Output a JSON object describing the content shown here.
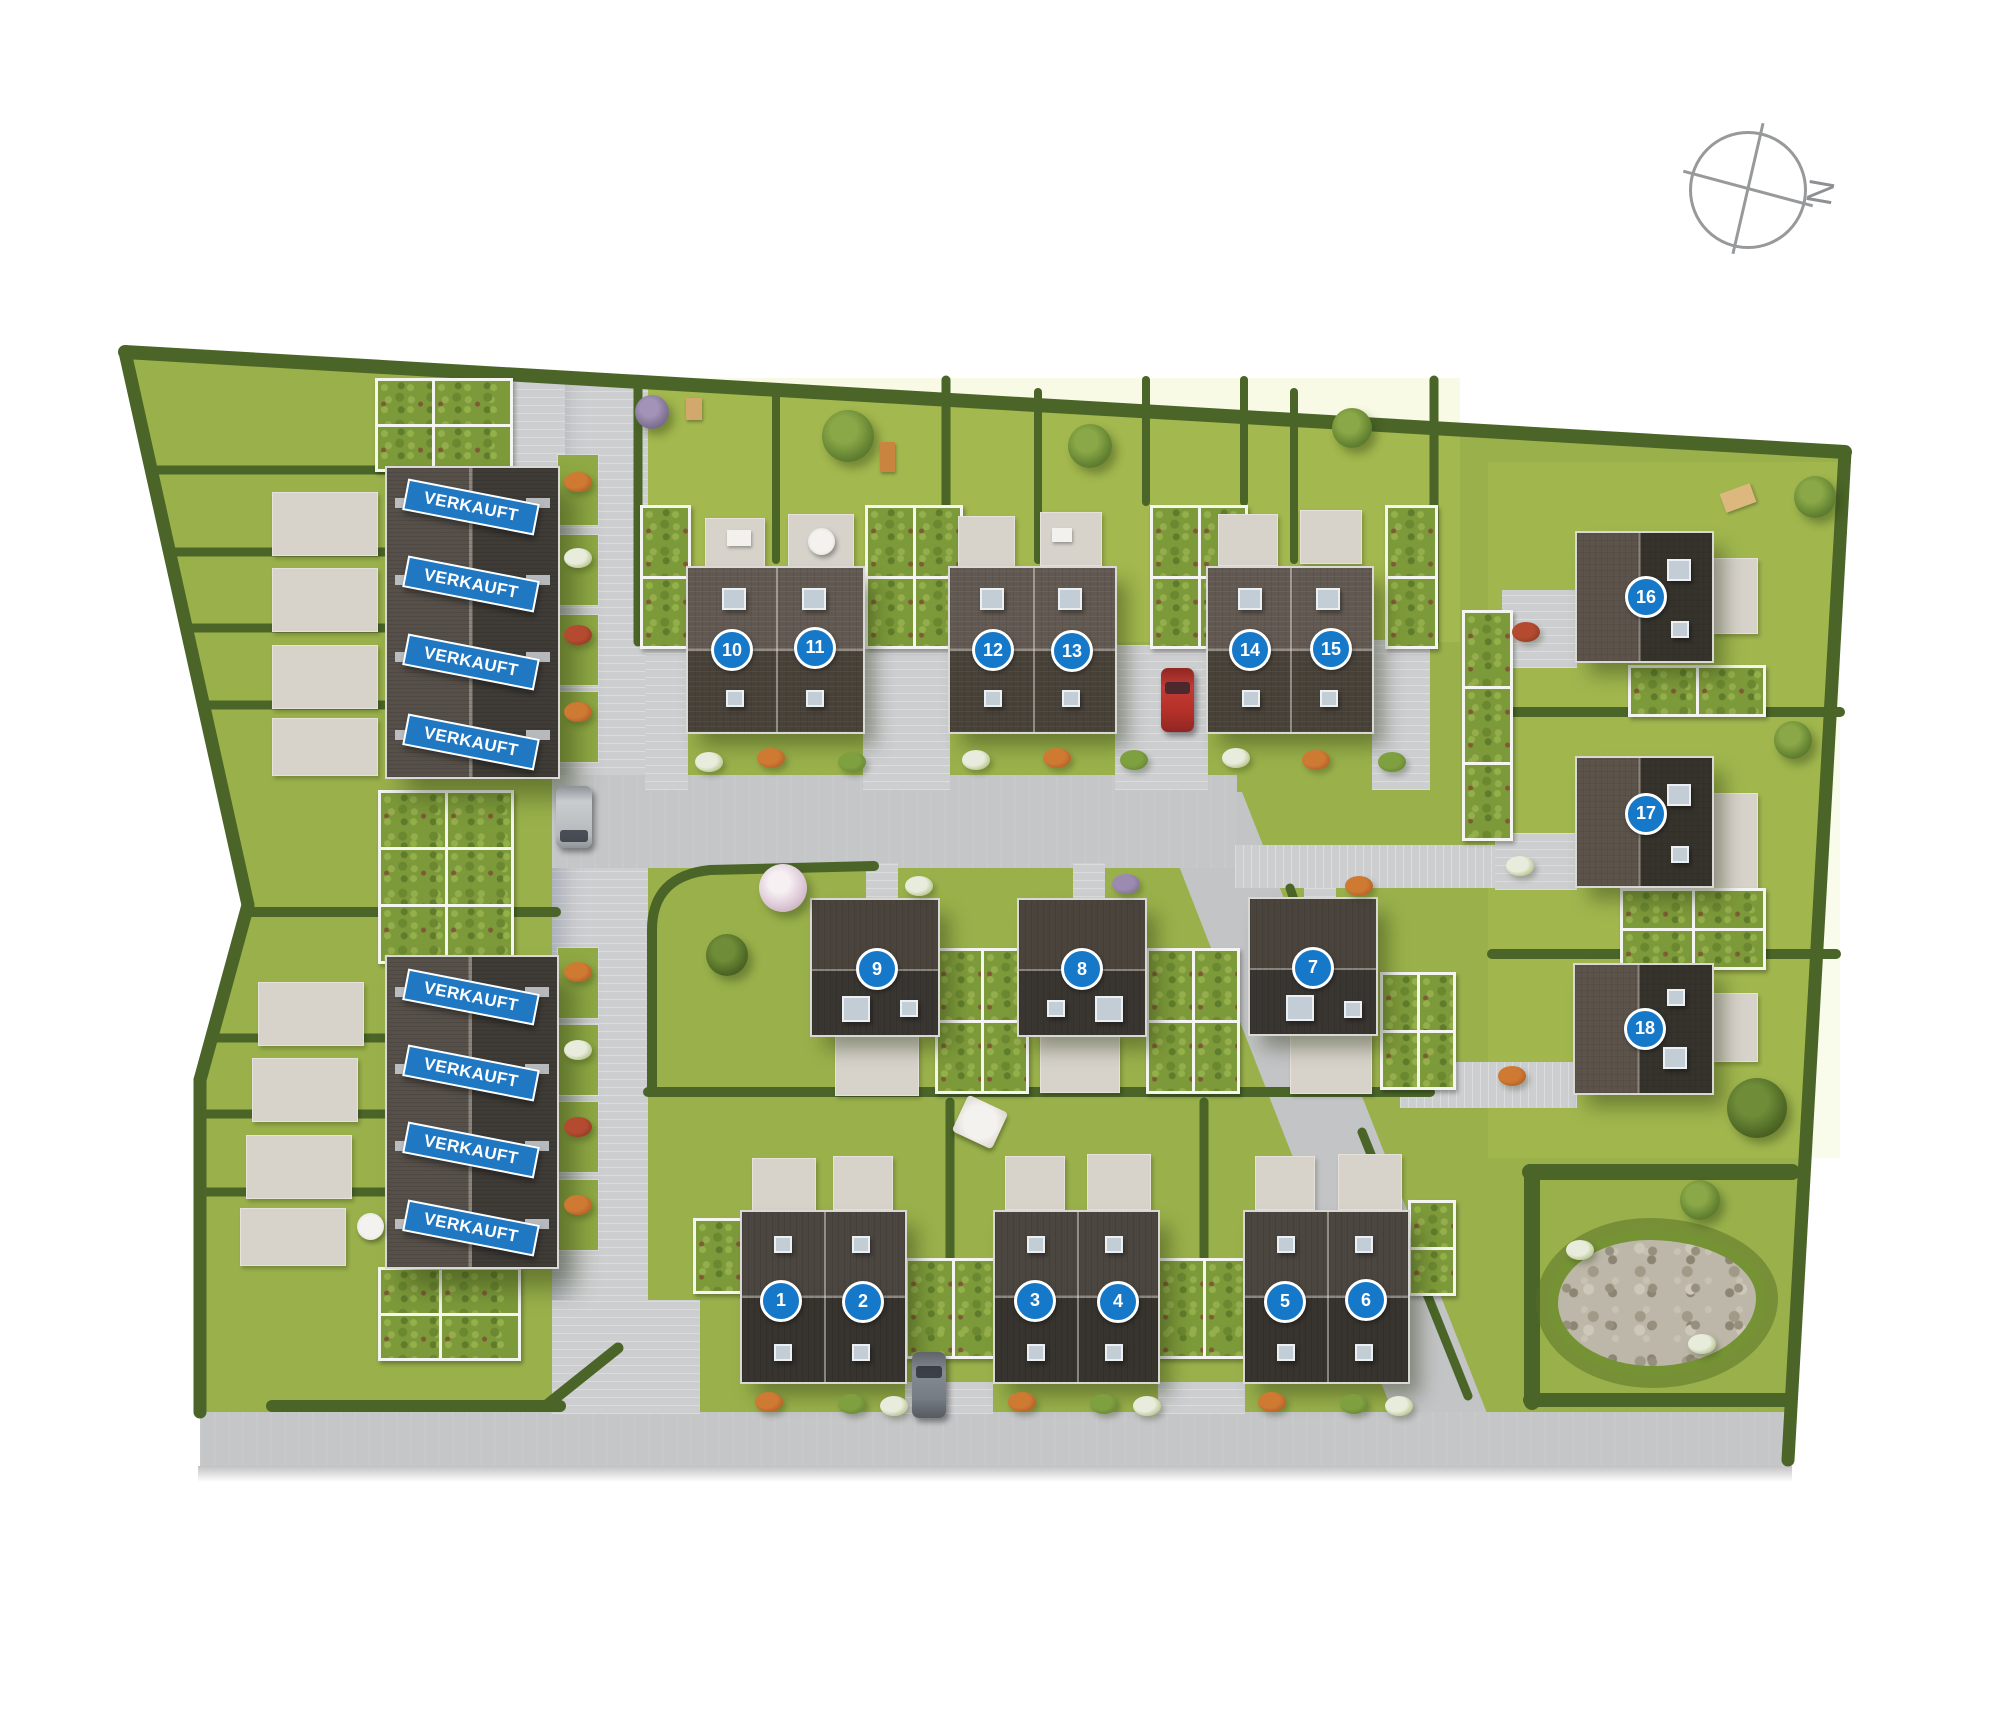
{
  "compass": {
    "label": "N"
  },
  "sold_label": "VERKAUFT",
  "banners": [
    {
      "label": "VERKAUFT",
      "x_pct": 23.55,
      "y_pct": 29.36
    },
    {
      "label": "VERKAUFT",
      "x_pct": 23.55,
      "y_pct": 33.82
    },
    {
      "label": "VERKAUFT",
      "x_pct": 23.55,
      "y_pct": 38.33
    },
    {
      "label": "VERKAUFT",
      "x_pct": 23.55,
      "y_pct": 42.97
    },
    {
      "label": "VERKAUFT",
      "x_pct": 23.55,
      "y_pct": 57.73
    },
    {
      "label": "VERKAUFT",
      "x_pct": 23.55,
      "y_pct": 62.13
    },
    {
      "label": "VERKAUFT",
      "x_pct": 23.55,
      "y_pct": 66.59
    },
    {
      "label": "VERKAUFT",
      "x_pct": 23.55,
      "y_pct": 71.11
    }
  ],
  "markers": [
    {
      "number": "1",
      "x_pct": 39.05,
      "y_pct": 75.33
    },
    {
      "number": "2",
      "x_pct": 43.15,
      "y_pct": 75.39
    },
    {
      "number": "3",
      "x_pct": 51.75,
      "y_pct": 75.33
    },
    {
      "number": "4",
      "x_pct": 55.9,
      "y_pct": 75.39
    },
    {
      "number": "5",
      "x_pct": 64.25,
      "y_pct": 75.39
    },
    {
      "number": "6",
      "x_pct": 68.3,
      "y_pct": 75.28
    },
    {
      "number": "7",
      "x_pct": 65.65,
      "y_pct": 56.05
    },
    {
      "number": "8",
      "x_pct": 54.1,
      "y_pct": 56.11
    },
    {
      "number": "9",
      "x_pct": 43.85,
      "y_pct": 56.11
    },
    {
      "number": "10",
      "x_pct": 36.6,
      "y_pct": 37.64
    },
    {
      "number": "11",
      "x_pct": 40.75,
      "y_pct": 37.52
    },
    {
      "number": "12",
      "x_pct": 49.65,
      "y_pct": 37.64
    },
    {
      "number": "13",
      "x_pct": 53.6,
      "y_pct": 37.7
    },
    {
      "number": "14",
      "x_pct": 62.5,
      "y_pct": 37.64
    },
    {
      "number": "15",
      "x_pct": 66.55,
      "y_pct": 37.58
    },
    {
      "number": "16",
      "x_pct": 82.3,
      "y_pct": 34.57
    },
    {
      "number": "17",
      "x_pct": 82.3,
      "y_pct": 47.13
    },
    {
      "number": "18",
      "x_pct": 82.25,
      "y_pct": 59.58
    }
  ],
  "colors": {
    "marker_blue": "#1578c8",
    "banner_blue": "#2178c2",
    "lawn": "#9ab14b",
    "hedge": "#4a6527",
    "road_grey": "#c5c6c8",
    "roof_light": "#5b544c",
    "roof_dark": "#3a3632",
    "compass_grey": "#97999b"
  },
  "vehicles": [
    "red-car",
    "grey-car",
    "grey-van"
  ]
}
